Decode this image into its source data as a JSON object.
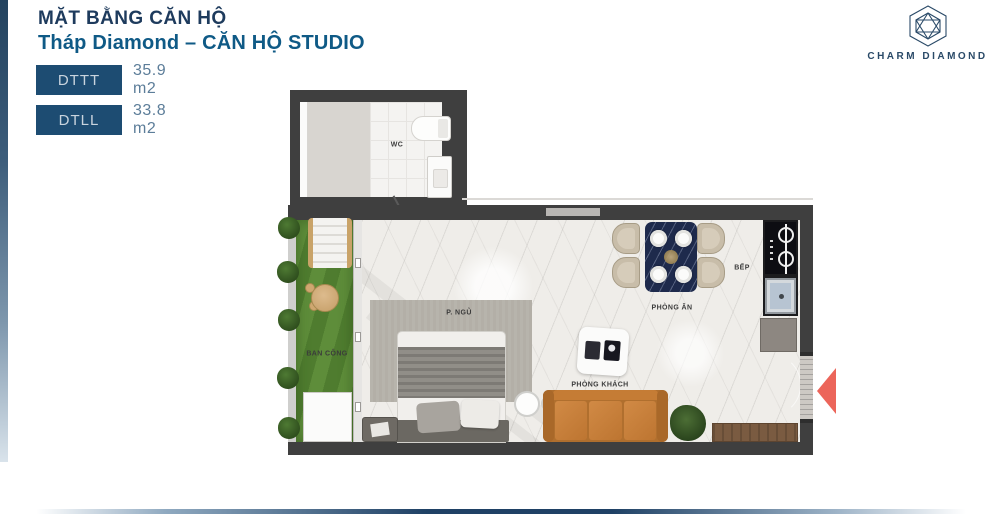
{
  "header": {
    "title": "MẶT BẰNG CĂN HỘ",
    "subtitle": "Tháp Diamond – CĂN HỘ STUDIO"
  },
  "legend": [
    {
      "code": "DTTT",
      "value": "35.9 m2"
    },
    {
      "code": "DTLL",
      "value": "33.8 m2"
    }
  ],
  "brand": {
    "name": "CHARM DIAMOND",
    "logo_icon": "hexagon-diamond-icon"
  },
  "floorplan": {
    "rooms": [
      {
        "id": "wc",
        "label": "WC"
      },
      {
        "id": "bedroom",
        "label": "P. NGỦ"
      },
      {
        "id": "balcony",
        "label": "BAN CÔNG"
      },
      {
        "id": "dining",
        "label": "PHÒNG ĂN"
      },
      {
        "id": "kitchen",
        "label": "BẾP"
      },
      {
        "id": "living",
        "label": "PHÒNG KHÁCH"
      }
    ],
    "entrance_indicator": "left-pointing-arrow"
  },
  "colors": {
    "title_navy": "#1e3b5d",
    "subtitle_blue": "#0f5a86",
    "badge_bg": "#1d4c72",
    "value_text": "#5c7d99",
    "wall_gray": "#3f3f3f",
    "grass_green": "#5e8d3a",
    "sofa_orange": "#c6803f",
    "dining_table_navy": "#1e2a4c",
    "arrow_red": "#ec655a"
  }
}
